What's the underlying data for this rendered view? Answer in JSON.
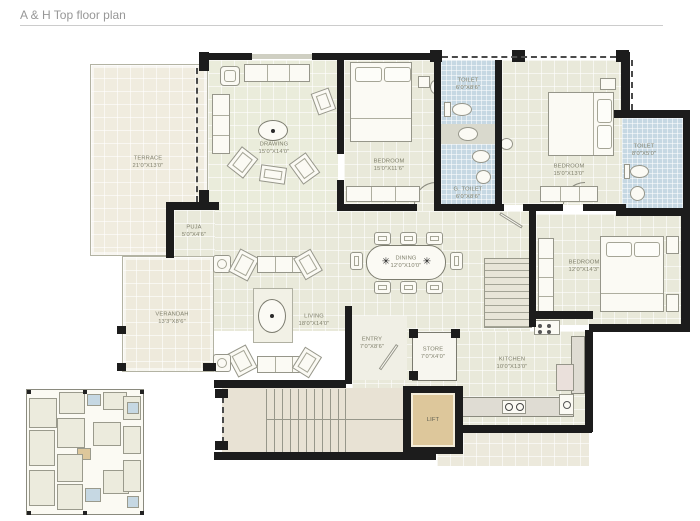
{
  "title": "A & H Top floor plan",
  "plan": {
    "rooms": {
      "terrace": {
        "name": "TERRACE",
        "dims": "21'0\"X13'0\""
      },
      "drawing": {
        "name": "DRAWING",
        "dims": "15'0\"X14'0\""
      },
      "bedroom1": {
        "name": "BEDROOM",
        "dims": "15'0\"X11'6\""
      },
      "toilet1": {
        "name": "TOILET",
        "dims": "6'0\"X8'6\""
      },
      "g_toilet": {
        "name": "G. TOILET",
        "dims": "6'0\"X8'6\""
      },
      "bedroom2": {
        "name": "BEDROOM",
        "dims": "15'0\"X13'0\""
      },
      "toilet2": {
        "name": "TOILET",
        "dims": "8'0\"X5'0\""
      },
      "bedroom3": {
        "name": "BEDROOM",
        "dims": "12'0\"X14'3\""
      },
      "dining": {
        "name": "DINING",
        "dims": "12'0\"X10'0\""
      },
      "living": {
        "name": "LIVING",
        "dims": "18'0\"X14'0\""
      },
      "puja": {
        "name": "PUJA",
        "dims": "5'0\"X4'6\""
      },
      "verandah": {
        "name": "VERANDAH",
        "dims": "13'3\"X8'6\""
      },
      "entry": {
        "name": "ENTRY",
        "dims": "7'0\"X8'6\""
      },
      "store": {
        "name": "STORE",
        "dims": "7'0\"X4'0\""
      },
      "kitchen": {
        "name": "KITCHEN",
        "dims": "10'0\"X13'0\""
      },
      "lift": {
        "name": "LIFT"
      }
    },
    "dining_motif": "✳",
    "colors": {
      "floor": "#e9e9da",
      "terrace_floor": "#f0ecdf",
      "toilet_tile": "#c6d8e3",
      "lift_fill": "#ddc79b",
      "wall": "#1c1c1c",
      "label": "#7f7f6b"
    }
  }
}
